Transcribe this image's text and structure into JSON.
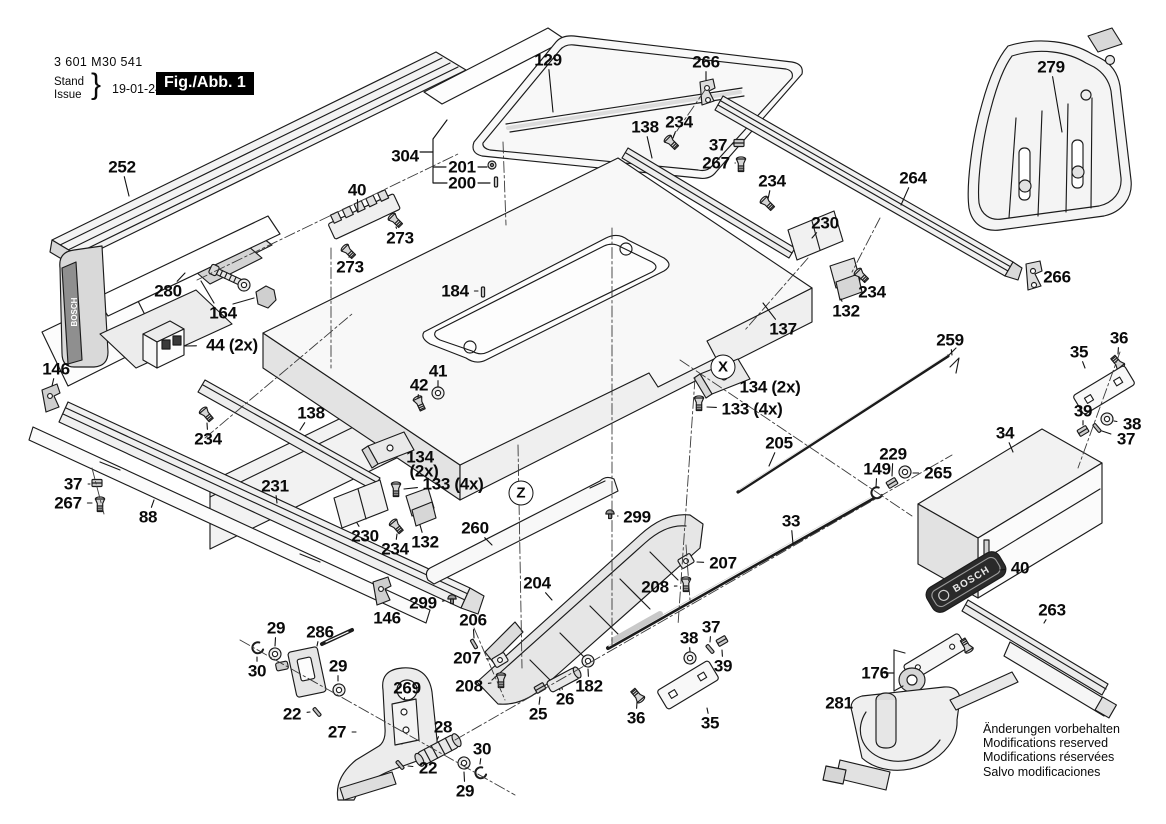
{
  "header": {
    "part_number": "3 601 M30 541",
    "stand_label": "Stand",
    "issue_label": "Issue",
    "brace": "}",
    "date": "19-01-24",
    "figure_label": "Fig./Abb. 1"
  },
  "brand": "BOSCH",
  "notes": [
    "Änderungen vorbehalten",
    "Modifications reserved",
    "Modifications réservées",
    "Salvo modificaciones"
  ],
  "markers": [
    {
      "label": "X",
      "x": 723,
      "y": 367
    },
    {
      "label": "Z",
      "x": 521,
      "y": 493
    }
  ],
  "parts": [
    {
      "l": "252",
      "x": 122,
      "y": 167,
      "lx": 129,
      "ly": 196
    },
    {
      "l": "129",
      "x": 548,
      "y": 60,
      "lx": 553,
      "ly": 112
    },
    {
      "l": "266",
      "x": 706,
      "y": 62,
      "lx": 706,
      "ly": 80
    },
    {
      "l": "279",
      "x": 1051,
      "y": 67,
      "lx": 1062,
      "ly": 132
    },
    {
      "l": "138",
      "x": 645,
      "y": 127,
      "lx": 652,
      "ly": 158
    },
    {
      "l": "234",
      "x": 679,
      "y": 122,
      "lx": 673,
      "ly": 138
    },
    {
      "l": "37",
      "x": 718,
      "y": 145,
      "lx": 733,
      "ly": 144
    },
    {
      "l": "267",
      "x": 716,
      "y": 163,
      "lx": 735,
      "ly": 163
    },
    {
      "l": "234",
      "x": 772,
      "y": 181,
      "lx": 768,
      "ly": 199
    },
    {
      "l": "264",
      "x": 913,
      "y": 178,
      "lx": 901,
      "ly": 205
    },
    {
      "l": "304",
      "x": 405,
      "y": 156
    },
    {
      "l": "201",
      "x": 462,
      "y": 167
    },
    {
      "l": "200",
      "x": 462,
      "y": 183
    },
    {
      "l": "40",
      "x": 357,
      "y": 190,
      "lx": 358,
      "ly": 212
    },
    {
      "l": "273",
      "x": 400,
      "y": 238,
      "lx": 396,
      "ly": 227
    },
    {
      "l": "273",
      "x": 350,
      "y": 267,
      "lx": 349,
      "ly": 257
    },
    {
      "l": "230",
      "x": 825,
      "y": 223,
      "lx": 812,
      "ly": 238
    },
    {
      "l": "280",
      "x": 168,
      "y": 291,
      "lx": 185,
      "ly": 273
    },
    {
      "l": "164",
      "x": 223,
      "y": 313
    },
    {
      "l": "234",
      "x": 872,
      "y": 292,
      "lx": 864,
      "ly": 281
    },
    {
      "l": "132",
      "x": 846,
      "y": 311,
      "lx": 841,
      "ly": 299
    },
    {
      "l": "266",
      "x": 1057,
      "y": 277,
      "lx": 1044,
      "ly": 278
    },
    {
      "l": "44 (2x)",
      "x": 232,
      "y": 345,
      "lx": 185,
      "ly": 346
    },
    {
      "l": "184",
      "x": 455,
      "y": 291,
      "lx": 478,
      "ly": 291
    },
    {
      "l": "137",
      "x": 783,
      "y": 329,
      "lx": 763,
      "ly": 303
    },
    {
      "l": "146",
      "x": 56,
      "y": 369,
      "lx": 52,
      "ly": 386
    },
    {
      "l": "36",
      "x": 1119,
      "y": 338,
      "lx": 1118,
      "ly": 354
    },
    {
      "l": "35",
      "x": 1079,
      "y": 352,
      "lx": 1085,
      "ly": 368
    },
    {
      "l": "259",
      "x": 950,
      "y": 340,
      "lx": 952,
      "ly": 355
    },
    {
      "l": "41",
      "x": 438,
      "y": 371,
      "lx": 438,
      "ly": 387
    },
    {
      "l": "42",
      "x": 419,
      "y": 385,
      "lx": 418,
      "ly": 398
    },
    {
      "l": "134 (2x)",
      "x": 770,
      "y": 387,
      "lx": 746,
      "ly": 386
    },
    {
      "l": "133 (4x)",
      "x": 752,
      "y": 409,
      "lx": 707,
      "ly": 407
    },
    {
      "l": "138",
      "x": 311,
      "y": 413,
      "lx": 300,
      "ly": 430
    },
    {
      "l": "234",
      "x": 208,
      "y": 439,
      "lx": 207,
      "ly": 423
    },
    {
      "l": "39",
      "x": 1083,
      "y": 411,
      "lx": 1083,
      "ly": 425
    },
    {
      "l": "38",
      "x": 1132,
      "y": 424,
      "lx": 1114,
      "ly": 421
    },
    {
      "l": "37",
      "x": 1126,
      "y": 439,
      "lx": 1102,
      "ly": 431
    },
    {
      "l": "34",
      "x": 1005,
      "y": 433,
      "lx": 1013,
      "ly": 452
    },
    {
      "l": "205",
      "x": 779,
      "y": 443,
      "lx": 769,
      "ly": 466
    },
    {
      "l": "229",
      "x": 893,
      "y": 454,
      "lx": 892,
      "ly": 476
    },
    {
      "l": "149",
      "x": 877,
      "y": 469,
      "lx": 876,
      "ly": 487
    },
    {
      "l": "265",
      "x": 938,
      "y": 473,
      "lx": 913,
      "ly": 473
    },
    {
      "l": "231",
      "x": 275,
      "y": 486,
      "lx": 277,
      "ly": 503
    },
    {
      "l": "37",
      "x": 73,
      "y": 484,
      "lx": 90,
      "ly": 484
    },
    {
      "l": "267",
      "x": 68,
      "y": 503,
      "lx": 92,
      "ly": 503
    },
    {
      "l": "88",
      "x": 148,
      "y": 517,
      "lx": 154,
      "ly": 500
    },
    {
      "l": "134",
      "x": 420,
      "y": 457,
      "lx": 404,
      "ly": 458
    },
    {
      "l": "(2x)",
      "x": 424,
      "y": 471
    },
    {
      "l": "133 (4x)",
      "x": 453,
      "y": 484,
      "lx": 404,
      "ly": 489
    },
    {
      "l": "260",
      "x": 475,
      "y": 528,
      "lx": 492,
      "ly": 545
    },
    {
      "l": "230",
      "x": 365,
      "y": 536,
      "lx": 357,
      "ly": 523
    },
    {
      "l": "234",
      "x": 395,
      "y": 549,
      "lx": 397,
      "ly": 534
    },
    {
      "l": "132",
      "x": 425,
      "y": 542,
      "lx": 420,
      "ly": 525
    },
    {
      "l": "299",
      "x": 637,
      "y": 517,
      "lx": 618,
      "ly": 516
    },
    {
      "l": "33",
      "x": 791,
      "y": 521,
      "lx": 793,
      "ly": 544
    },
    {
      "l": "204",
      "x": 537,
      "y": 583,
      "lx": 552,
      "ly": 600
    },
    {
      "l": "207",
      "x": 723,
      "y": 563,
      "lx": 697,
      "ly": 562
    },
    {
      "l": "208",
      "x": 655,
      "y": 587,
      "lx": 677,
      "ly": 586
    },
    {
      "l": "299",
      "x": 423,
      "y": 603,
      "lx": 444,
      "ly": 601
    },
    {
      "l": "146",
      "x": 387,
      "y": 618
    },
    {
      "l": "206",
      "x": 473,
      "y": 620,
      "lx": 474,
      "ly": 638
    },
    {
      "l": "207",
      "x": 467,
      "y": 658,
      "lx": 490,
      "ly": 659
    },
    {
      "l": "208",
      "x": 469,
      "y": 686,
      "lx": 491,
      "ly": 683
    },
    {
      "l": "29",
      "x": 276,
      "y": 628,
      "lx": 275,
      "ly": 646
    },
    {
      "l": "286",
      "x": 320,
      "y": 632,
      "lx": 317,
      "ly": 646
    },
    {
      "l": "30",
      "x": 257,
      "y": 671,
      "lx": 257,
      "ly": 657
    },
    {
      "l": "29",
      "x": 338,
      "y": 666,
      "lx": 338,
      "ly": 681
    },
    {
      "l": "22",
      "x": 292,
      "y": 714,
      "lx": 310,
      "ly": 712
    },
    {
      "l": "27",
      "x": 337,
      "y": 732,
      "lx": 356,
      "ly": 732
    },
    {
      "l": "269",
      "x": 407,
      "y": 688,
      "lx": 404,
      "ly": 700
    },
    {
      "l": "28",
      "x": 443,
      "y": 727,
      "lx": 437,
      "ly": 740
    },
    {
      "l": "30",
      "x": 482,
      "y": 749,
      "lx": 480,
      "ly": 764
    },
    {
      "l": "22",
      "x": 428,
      "y": 768,
      "lx": 408,
      "ly": 766
    },
    {
      "l": "29",
      "x": 465,
      "y": 791,
      "lx": 464,
      "ly": 772
    },
    {
      "l": "25",
      "x": 538,
      "y": 714,
      "lx": 540,
      "ly": 697
    },
    {
      "l": "26",
      "x": 565,
      "y": 699,
      "lx": 562,
      "ly": 688
    },
    {
      "l": "182",
      "x": 589,
      "y": 686,
      "lx": 588,
      "ly": 669
    },
    {
      "l": "38",
      "x": 689,
      "y": 638,
      "lx": 690,
      "ly": 652
    },
    {
      "l": "37",
      "x": 711,
      "y": 627,
      "lx": 710,
      "ly": 642
    },
    {
      "l": "39",
      "x": 723,
      "y": 666,
      "lx": 722,
      "ly": 650
    },
    {
      "l": "36",
      "x": 636,
      "y": 718,
      "lx": 637,
      "ly": 702
    },
    {
      "l": "35",
      "x": 710,
      "y": 723,
      "lx": 707,
      "ly": 708
    },
    {
      "l": "40",
      "x": 1020,
      "y": 568,
      "lx": 1000,
      "ly": 570
    },
    {
      "l": "263",
      "x": 1052,
      "y": 610,
      "lx": 1044,
      "ly": 623
    },
    {
      "l": "176",
      "x": 875,
      "y": 673
    },
    {
      "l": "281",
      "x": 839,
      "y": 703,
      "lx": 856,
      "ly": 705
    }
  ]
}
